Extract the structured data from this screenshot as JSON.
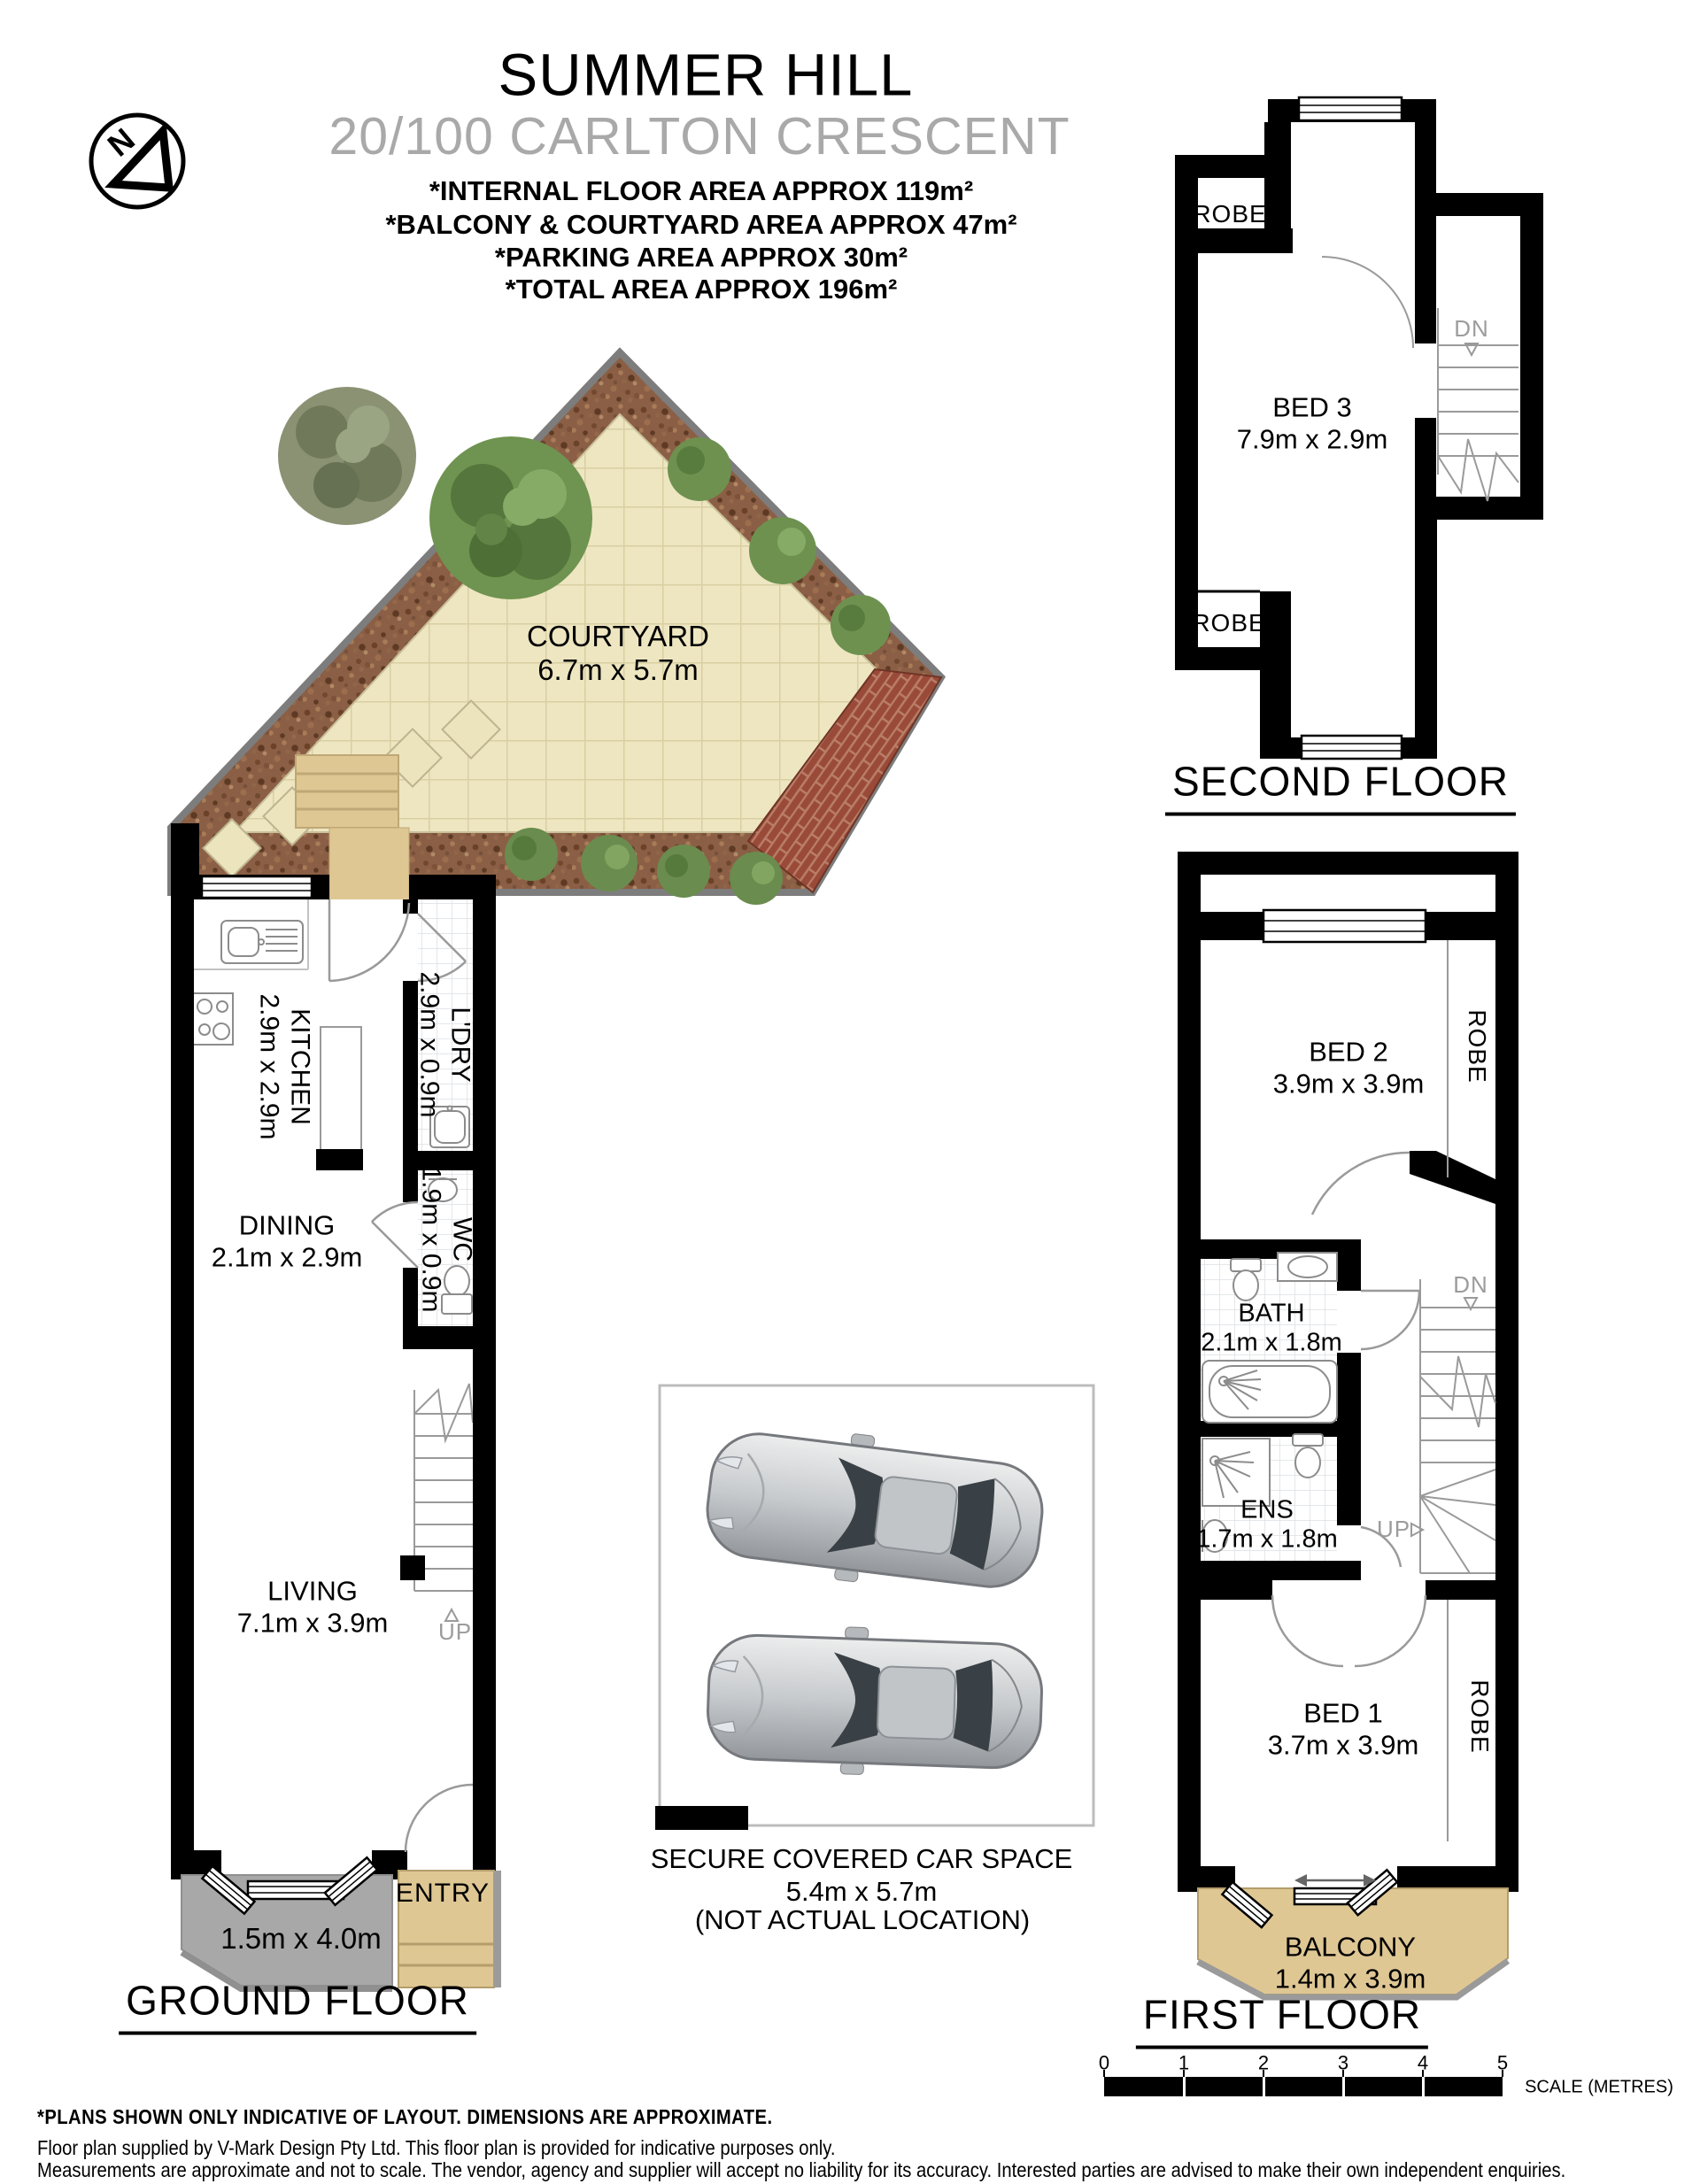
{
  "header": {
    "suburb": "SUMMER HILL",
    "address": "20/100 CARLTON CRESCENT",
    "area_lines": [
      "*INTERNAL FLOOR AREA APPROX 119m²",
      "*BALCONY & COURTYARD AREA APPROX 47m²",
      "*PARKING AREA APPROX 30m²",
      "*TOTAL AREA APPROX 196m²"
    ],
    "compass_letter": "N"
  },
  "courtyard": {
    "name": "COURTYARD",
    "dims": "6.7m x 5.7m"
  },
  "ground_floor": {
    "label": "GROUND FLOOR",
    "kitchen_name": "KITCHEN",
    "kitchen_dims": "2.9m x 2.9m",
    "laundry_name": "L'DRY",
    "laundry_dims": "2.9m x 0.9m",
    "wc_name": "WC",
    "wc_dims": "1.9m x 0.9m",
    "dining_name": "DINING",
    "dining_dims": "2.1m x 2.9m",
    "living_name": "LIVING",
    "living_dims": "7.1m x 3.9m",
    "entry_name": "ENTRY",
    "porch_dims": "1.5m x 4.0m",
    "stairs_up": "UP"
  },
  "first_floor": {
    "label": "FIRST FLOOR",
    "bed2_name": "BED 2",
    "bed2_dims": "3.9m x 3.9m",
    "bath_name": "BATH",
    "bath_dims": "2.1m x 1.8m",
    "ens_name": "ENS",
    "ens_dims": "1.7m x 1.8m",
    "bed1_name": "BED 1",
    "bed1_dims": "3.7m x 3.9m",
    "balcony_name": "BALCONY",
    "balcony_dims": "1.4m x 3.9m",
    "robe_upper": "ROBE",
    "robe_lower": "ROBE",
    "stairs_down": "DN",
    "stairs_up": "UP"
  },
  "second_floor": {
    "label": "SECOND FLOOR",
    "bed3_name": "BED 3",
    "bed3_dims": "7.9m x 2.9m",
    "robe_upper": "ROBE",
    "robe_lower": "ROBE",
    "stairs_down": "DN"
  },
  "car_space": {
    "line1": "SECURE COVERED CAR SPACE",
    "line2": "5.4m x 5.7m",
    "line3": "(NOT ACTUAL LOCATION)"
  },
  "scale_bar": {
    "ticks": [
      "0",
      "1",
      "2",
      "3",
      "4",
      "5"
    ],
    "caption": "SCALE (METRES)"
  },
  "footer": {
    "line1": "*PLANS SHOWN ONLY INDICATIVE OF LAYOUT. DIMENSIONS ARE APPROXIMATE.",
    "line2": "Floor plan supplied by V-Mark Design Pty Ltd. This floor plan is provided for indicative purposes only.",
    "line3": "Measurements are approximate and not to scale. The vendor, agency and supplier will accept no liability for its accuracy. Interested parties are advised to make their own independent enquiries."
  },
  "colors": {
    "mulch": "#8b5f45",
    "pavers": "#eee6c1",
    "brick": "#9a4a38",
    "tan": "#dfc794",
    "porch_gray": "#a8a8a8",
    "muted_text": "#9c9c9c"
  }
}
